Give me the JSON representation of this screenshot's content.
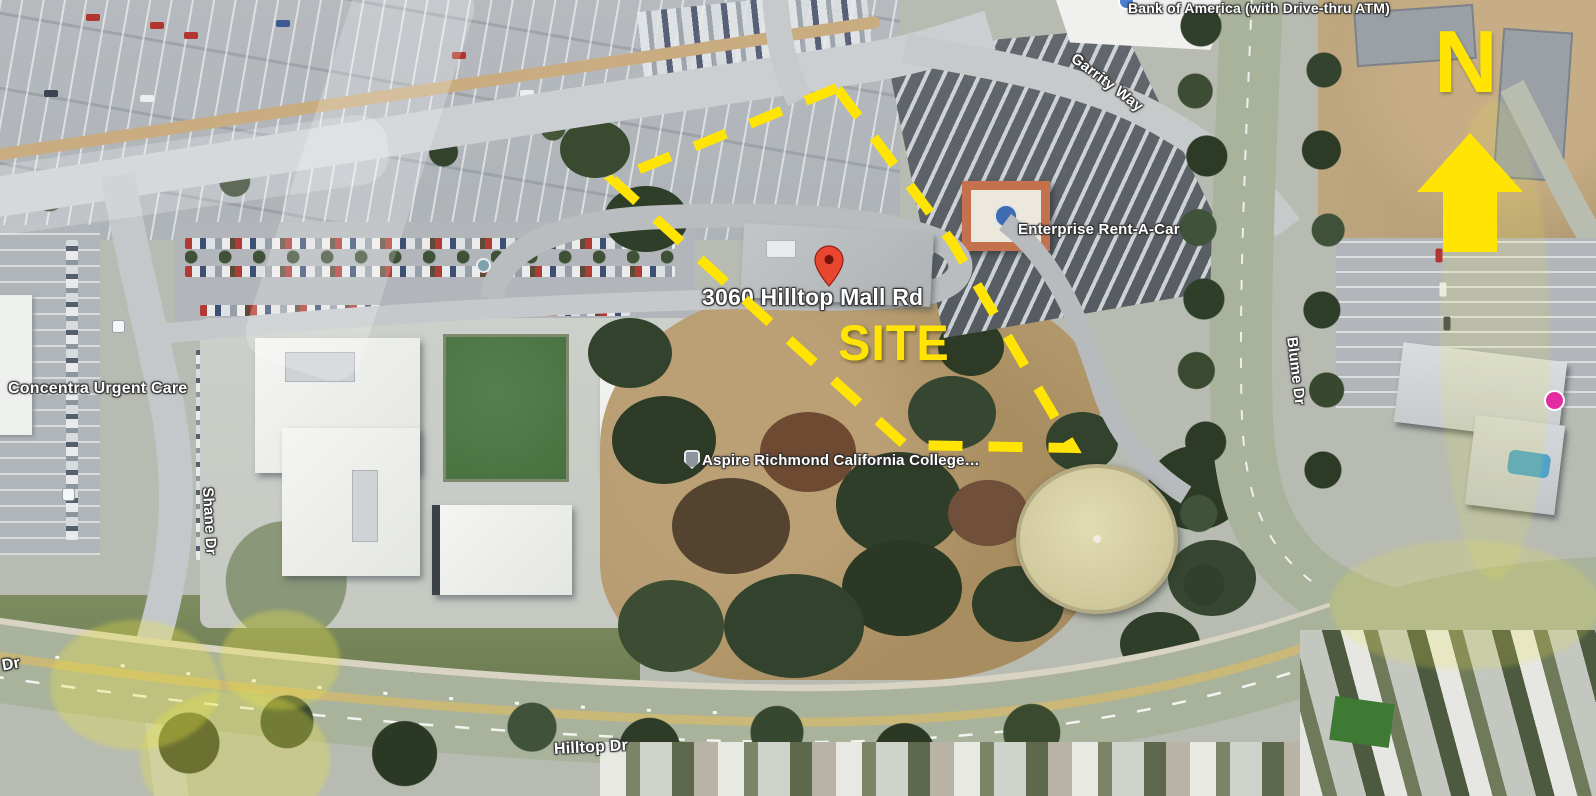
{
  "figure": {
    "type": "annotated aerial site map",
    "site_label": "SITE",
    "north_letter": "N",
    "address_label": "3060 Hilltop Mall Rd"
  },
  "map_labels": {
    "bank_of_america": "Bank of America (with Drive-thru ATM)",
    "garrity_way": "Garrity Way",
    "enterprise_rent_a_car": "Enterprise Rent-A-Car",
    "concentra_urgent_care": "Concentra Urgent Care",
    "shane_dr": "Shane Dr",
    "aspire_college": "Aspire Richmond California College…",
    "blume_dr": "Blume Dr",
    "hilltop_dr": "Hilltop Dr",
    "dr_partial": "Dr"
  },
  "icons": {
    "location_pin": "red-map-pin",
    "north_arrow": "yellow-block-arrow-up",
    "school_shield": "school-shield-poi",
    "bank_poi": "blue-circle-poi",
    "business_poi": "pink-circle-poi",
    "transit_poi": "transit-square-poi",
    "roundabout_poi": "teal-circle-poi"
  },
  "colors": {
    "annotation_yellow": "#FFE404",
    "pin_red": "#E8462F",
    "label_text": "#FFFFFF",
    "label_halo": "#3E3E3E"
  }
}
